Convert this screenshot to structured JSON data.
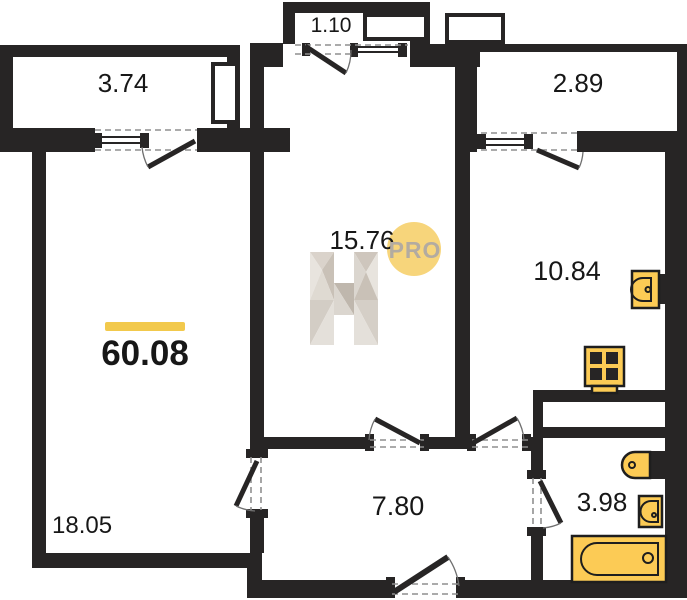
{
  "plan": {
    "total_area": {
      "value": "60.08"
    },
    "rooms": {
      "balcony_left": "3.74",
      "balcony_center": "1.10",
      "balcony_right": "2.89",
      "living_room": "15.76",
      "kitchen": "10.84",
      "bedroom": "18.05",
      "hallway": "7.80",
      "bathroom": "3.98"
    },
    "watermark": {
      "letter": "H",
      "badge": "PRO"
    },
    "fixtures": [
      "kitchen-sink-icon",
      "stove-icon",
      "toilet-icon",
      "washbasin-icon",
      "bathtub-icon"
    ],
    "colors": {
      "wall": "#272525",
      "dash": "#8f8f8f",
      "fixture_fill": "#fccb55",
      "fixture_border": "#1e1e1e",
      "accent_bar": "#f2c94c",
      "badge_bg": "#f7d57b",
      "badge_text": "#b3aba1"
    }
  }
}
